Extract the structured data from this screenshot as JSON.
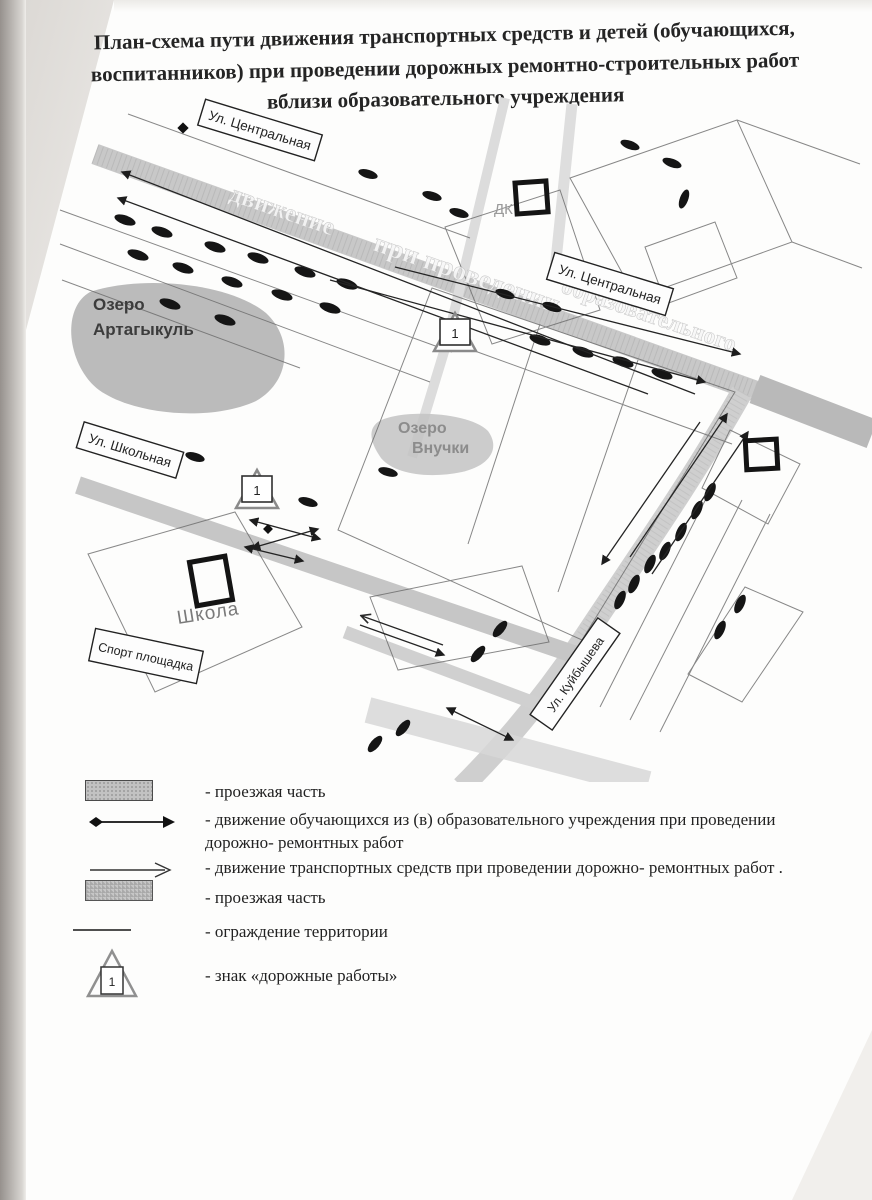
{
  "document": {
    "title": "План-схема пути движения транспортных средств и детей (обучающихся, воспитанников) при проведении дорожных ремонтно-строительных работ вблизи образовательного учреждения"
  },
  "map": {
    "street_labels": {
      "central_top": "Ул. Центральная",
      "central_mid": "Ул. Центральная",
      "school_street": "Ул. Школьная",
      "kuibyshev": "Ул. Куйбышева"
    },
    "places": {
      "lake1_line1": "Озеро",
      "lake1_line2": "Артагыкуль",
      "lake2_line1": "Озеро",
      "lake2_line2": "Внучки",
      "school": "Школа",
      "sport": "Спорт площадка",
      "dk": "ДК"
    },
    "signs": {
      "sign1": "1",
      "sign2": "1"
    },
    "ghost": {
      "g1": "движение",
      "g2": "при проведении",
      "g3": "образовательного"
    }
  },
  "legend": {
    "roadworks_number": "1",
    "items": [
      {
        "symbol": "road-strip",
        "label": "- проезжая часть"
      },
      {
        "symbol": "children-arrow",
        "label": "- движение обучающихся из (в) образовательного учреждения при проведении дорожно- ремонтных работ"
      },
      {
        "symbol": "vehicle-arrow",
        "label": "- движение транспортных средств при проведении дорожно- ремонтных работ ."
      },
      {
        "symbol": "road-strip-hatch",
        "label": "- проезжая часть"
      },
      {
        "symbol": "fence-line",
        "label": "- ограждение территории"
      },
      {
        "symbol": "roadworks-sign",
        "label": "- знак «дорожные работы»"
      }
    ]
  },
  "colors": {
    "road": "#c8c8c8",
    "lake": "#b4b4b4",
    "ink": "#1a1a1a",
    "car": "#151515"
  }
}
